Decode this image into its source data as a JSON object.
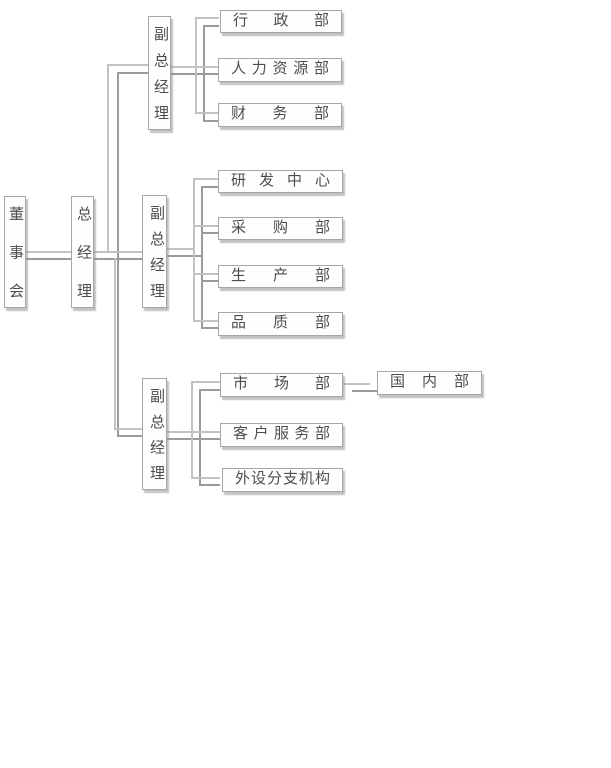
{
  "diagram_type": "organizational-chart",
  "colors": {
    "background": "#ffffff",
    "box_fill": "#fefefe",
    "box_border": "#a6a6a6",
    "box_shadow": "#919191",
    "line_light": "#c2c2c2",
    "line_dark": "#9b9b9b",
    "text": "#4d4d4d"
  },
  "tree": {
    "label": "董事会",
    "children": [
      {
        "label": "总经理",
        "children": [
          {
            "label": "副总经理",
            "children": [
              {
                "label": "行政部"
              },
              {
                "label": "人力资源部"
              },
              {
                "label": "财务部"
              }
            ]
          },
          {
            "label": "副总经理",
            "children": [
              {
                "label": "研发中心"
              },
              {
                "label": "采购部"
              },
              {
                "label": "生产部"
              },
              {
                "label": "品质部"
              }
            ]
          },
          {
            "label": "副总经理",
            "children": [
              {
                "label": "市场部",
                "children": [
                  {
                    "label": "国内部"
                  }
                ]
              },
              {
                "label": "客户服务部"
              },
              {
                "label": "外设分支机构"
              }
            ]
          }
        ]
      }
    ]
  }
}
